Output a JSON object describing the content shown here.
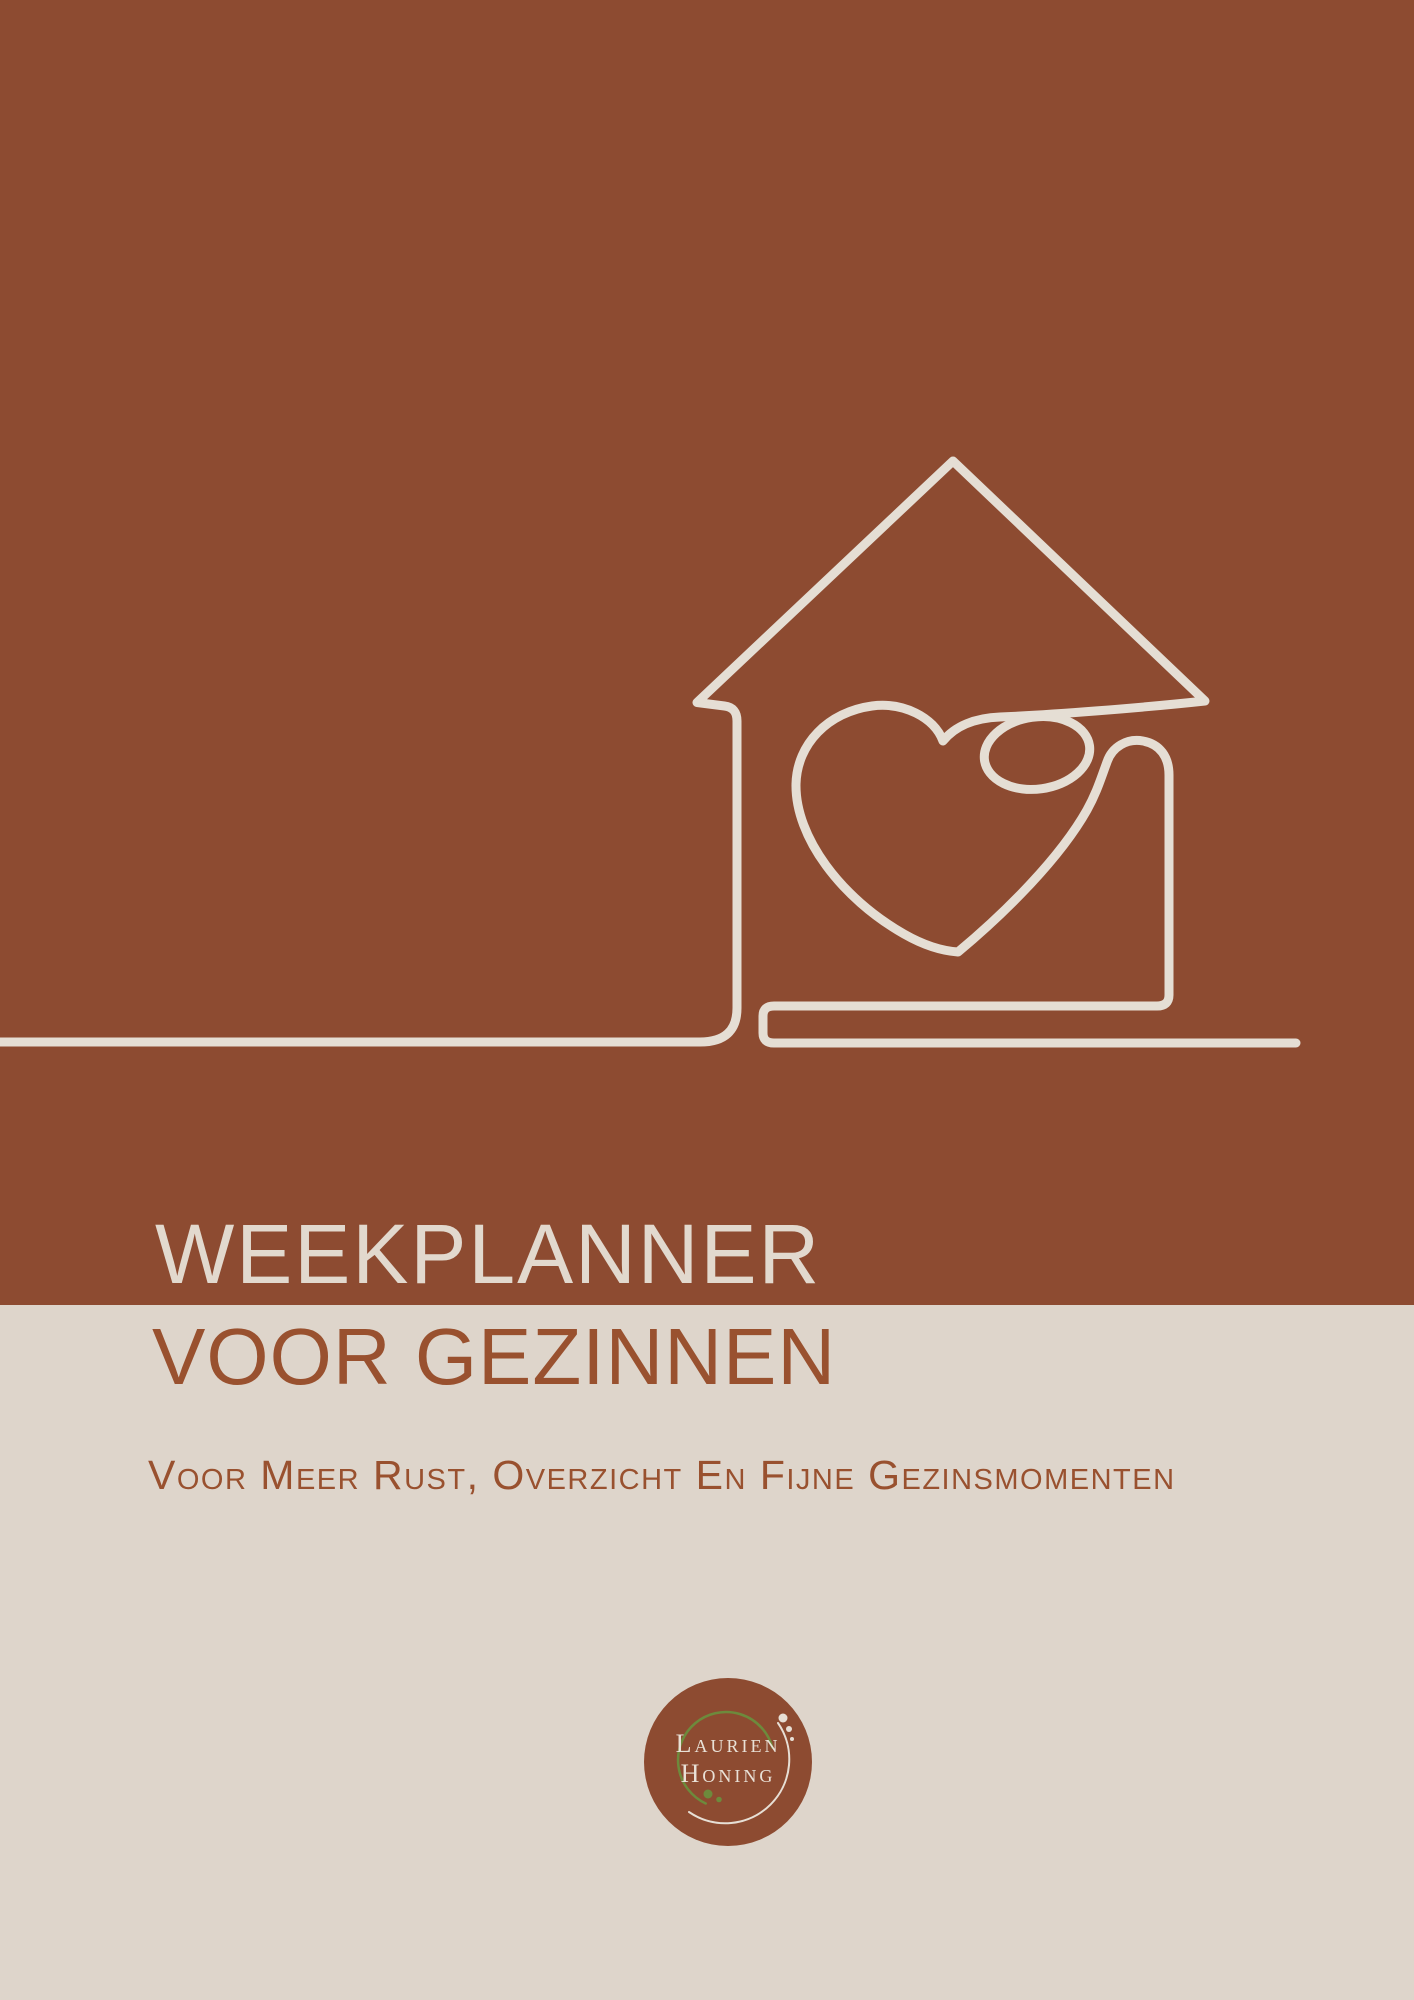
{
  "cover": {
    "title_line1": "WEEKPLANNER",
    "title_line2": "VOOR GEZINNEN",
    "subtitle": "Voor Meer Rust, Overzicht En Fijne Gezinsmomenten"
  },
  "logo": {
    "name_line1": "Laurien",
    "name_line2": "Honing"
  },
  "illustration": {
    "name": "house-with-heart-one-line-drawing"
  },
  "colors": {
    "terracotta": "#8d4b31",
    "cream": "#ded5cb",
    "line_cream": "#e5ded4",
    "title_cream": "#e2d9ce",
    "text_brown": "#99512f",
    "olive_green": "#6d8a3c"
  }
}
